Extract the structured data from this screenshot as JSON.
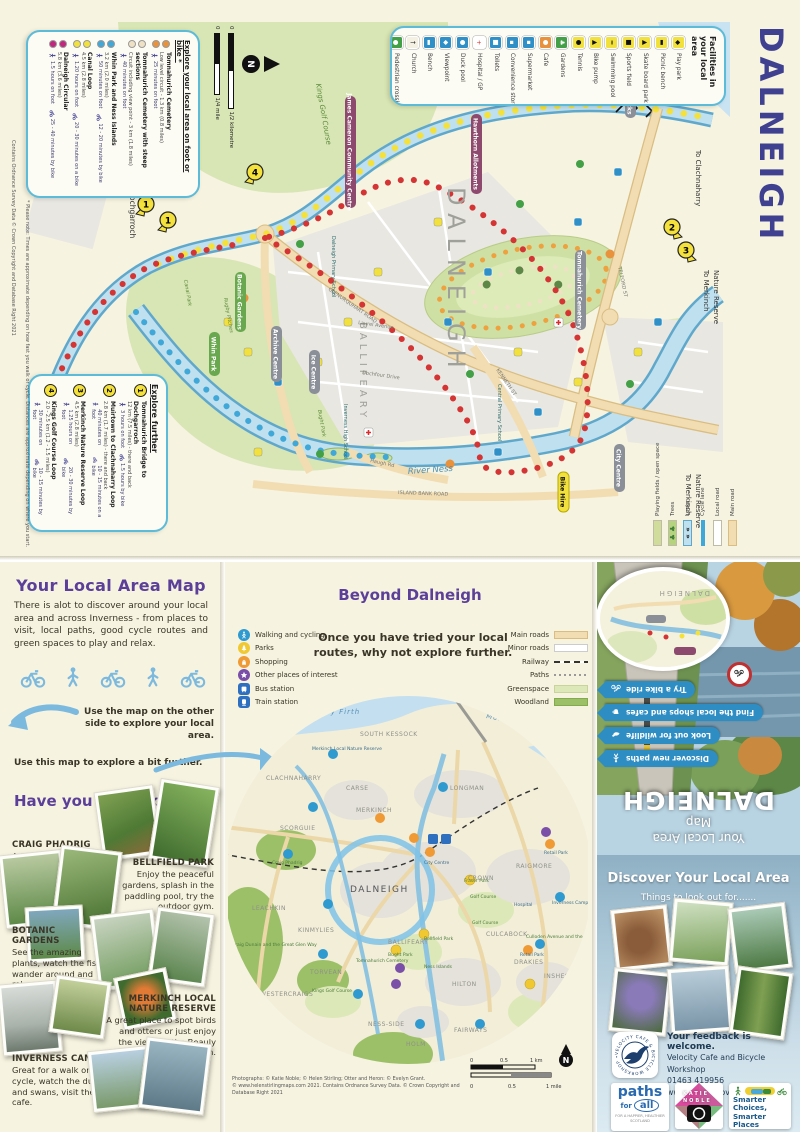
{
  "colors": {
    "accent_purple": "#5b3f99",
    "navy": "#3f4190",
    "light_blue": "#7cb9de",
    "ribbon_blue": "#2e8dc3"
  },
  "top_map": {
    "title": "DALNEIGH",
    "compass": "N",
    "scale": {
      "zero1": "0",
      "km": "1/2 kilometre",
      "zero2": "0",
      "mile": "1/4 mile"
    },
    "note": "* Please note: Times are approximate depending on how fast you walk or cycle. Distances are approximate depending on where you start.",
    "copyright": "Contains Ordnance Survey Data © Crown Copyright and Database Right 2021",
    "explore_local": {
      "title": "Explore your local area on foot or bike *",
      "routes": [
        {
          "name": "Tomnahurich Cemetery",
          "detail": "Low level circuit - 1.3 km (0.8 miles)",
          "foot": "25 minutes on foot",
          "bike": "",
          "color": "#e8923d"
        },
        {
          "name": "Tomnahurich Cemetery with steep sections",
          "detail": "Circuit including view point - 3 km (1.8 miles)",
          "foot": "40 minutes on foot",
          "bike": "",
          "color": "#efe2c4"
        },
        {
          "name": "Whin Park and Ness Islands",
          "detail": "3.2 km (2.0 miles)",
          "foot": "50 minutes on foot",
          "bike": "12 - 20 minutes by bike",
          "color": "#41a8d8"
        },
        {
          "name": "Canal Loop",
          "detail": "4.5 km (2.8 miles)",
          "foot": "1.20 hours on foot",
          "bike": "20 - 30 minutes on a bike",
          "color": "#f2e13c"
        },
        {
          "name": "Dalneigh Circular",
          "detail": "5.8 km (3.6 miles)",
          "foot": "1.5 hours on foot",
          "bike": "25 - 40 minutes by bike",
          "color": "#c2267d"
        }
      ]
    },
    "facilities": {
      "title": "Facilities in your local area",
      "items": [
        {
          "label": "Pedestrian crossing",
          "color": "#43a047",
          "g": "●",
          "gc": "#ffffff"
        },
        {
          "label": "Church",
          "color": "#f4f1e2",
          "g": "†",
          "gc": "#111111"
        },
        {
          "label": "Bench",
          "color": "#2f8fc7",
          "g": "▬",
          "gc": "#ffffff"
        },
        {
          "label": "Viewpoint",
          "color": "#2f8fc7",
          "g": "◆",
          "gc": "#ffffff"
        },
        {
          "label": "Duck pool",
          "color": "#2f8fc7",
          "g": "●",
          "gc": "#ffffff"
        },
        {
          "label": "Hospital / GP",
          "color": "#ffffff",
          "g": "+",
          "gc": "#d92c2c"
        },
        {
          "label": "Toilets",
          "color": "#2f8fc7",
          "g": "■",
          "gc": "#ffffff"
        },
        {
          "label": "Convenience store",
          "color": "#2f8fc7",
          "g": "▪",
          "gc": "#ffffff"
        },
        {
          "label": "Supermarket",
          "color": "#2f8fc7",
          "g": "▪",
          "gc": "#ffffff"
        },
        {
          "label": "Cafe",
          "color": "#e8923d",
          "g": "●",
          "gc": "#ffffff"
        },
        {
          "label": "Gardens",
          "color": "#43a047",
          "g": "♣",
          "gc": "#ffffff"
        },
        {
          "label": "Tennis",
          "color": "#f2e13c",
          "g": "●",
          "gc": "#111111"
        },
        {
          "label": "Bike pump",
          "color": "#f2e13c",
          "g": "▲",
          "gc": "#111111"
        },
        {
          "label": "Swimming pool",
          "color": "#f2e13c",
          "g": "≈",
          "gc": "#111111"
        },
        {
          "label": "Sports field",
          "color": "#f2e13c",
          "g": "■",
          "gc": "#111111"
        },
        {
          "label": "Skate board park",
          "color": "#f2e13c",
          "g": "▲",
          "gc": "#111111"
        },
        {
          "label": "Picnic bench",
          "color": "#f2e13c",
          "g": "▬",
          "gc": "#111111"
        },
        {
          "label": "Play park",
          "color": "#f2e13c",
          "g": "◆",
          "gc": "#111111"
        }
      ]
    },
    "explore_further": {
      "title": "Explore further",
      "routes": [
        {
          "num": "1",
          "name": "Tomnahurich Bridge to Dochgarroch",
          "detail": "12 km (7.5 miles) - there and back",
          "foot": "3 hours on foot",
          "bike": "1.5 hours by bike"
        },
        {
          "num": "2",
          "name": "Muirtown to Clachnaharry Loop",
          "detail": "2.8 km (1.7 miles) - there and back",
          "foot": "40 minutes on foot",
          "bike": "10 - 15 minutes on a bike"
        },
        {
          "num": "3",
          "name": "Merkinch Nature Reserve Loop",
          "detail": "4.5 km (2.8 miles)",
          "foot": "1.25 hours on foot",
          "bike": "20 - 30 minutes by bike"
        },
        {
          "num": "4",
          "name": "Kings Golf Course Loop",
          "detail": "2.0 - 2.5 km (1.2 - 1.5 miles)",
          "foot": "30 minutes on foot",
          "bike": "10 - 15 minutes by bike"
        }
      ]
    },
    "markers": [
      "1",
      "1",
      "2",
      "3",
      "4"
    ],
    "edge_labels": {
      "dochgarroch": "To Dochgarroch",
      "clachnaharry": "To Clachnaharry",
      "merkinch1": "To Merkinch",
      "merkinch2": "Nature Reserve"
    },
    "districts": {
      "dalneigh": "DALNEIGH",
      "ballifeary": "BALLIFEARY"
    },
    "water": {
      "river": "River Ness"
    },
    "roads": {
      "glenurquhart": "GLENURQUHART ROAD",
      "telford": "TELFORD ST",
      "kingbrude": "King Brude Road",
      "islandbank": "ISLAND BANK ROAD",
      "laurel": "Laurel Avenue",
      "dochfour": "Dochfour Drive",
      "kenneth": "KENNETH ST",
      "haugh": "Haugh Rd"
    },
    "green_labels": {
      "kings": "Kings Golf Course",
      "canalpark": "Canal Park",
      "rugby": "Rugby Pitches",
      "bught": "Bught Park"
    },
    "pills": {
      "whin": "Whin Park",
      "botanic": "Botanic Gardens",
      "archive": "Archive Centre",
      "ice": "Ice Centre",
      "muirtown": "Muirtown Locks",
      "city": "City Centre",
      "cemetery": "Tomnahurich Cemetery",
      "jamescameron": "James Cameron Community Centre",
      "hawthorn": "Hawthorn Allotments",
      "bikehire": "Bike Hire"
    },
    "schools": {
      "dalneigh_primary": "Dalneigh Primary School",
      "high": "Inverness High School",
      "central": "Central Primary School"
    },
    "mini_legend": [
      {
        "label": "Playing fields / open space",
        "kind": "fields"
      },
      {
        "label": "Trees",
        "kind": "trees"
      },
      {
        "label": "Locks",
        "kind": "locks"
      },
      {
        "label": "Cycle lane",
        "kind": "cycle"
      },
      {
        "label": "Local road",
        "kind": "local"
      },
      {
        "label": "Main road",
        "kind": "main"
      }
    ]
  },
  "left_panel": {
    "title": "Your Local Area Map",
    "intro": "There is alot to discover around your local area and across Inverness - from places to visit, local paths, good cycle routes and green spaces to play and relax.",
    "other_side": "Use the map on the other side to explore your local area.",
    "this_map": "Use this map  to explore a bit further.",
    "have_you": "Have you been to.......",
    "places": [
      {
        "name": "CRAIG PHADRIG",
        "desc": "A beautiful forest walk that takes you up the site of an historic hill fort."
      },
      {
        "name": "BELLFIELD PARK",
        "desc": "Enjoy the peaceful gardens, splash in the paddling pool, try the outdoor gym."
      },
      {
        "name": "BOTANIC GARDENS",
        "desc": "See the amazing plants, watch the fish, wander around and relax....inside or out."
      },
      {
        "name": "MERKINCH LOCAL NATURE RESERVE",
        "desc": "A great place to spot birds and otters or just enjoy the views of the Beauly Firth."
      },
      {
        "name": "INVERNESS CAMPUS",
        "desc": "Great for a walk or a cycle, watch the ducks and swans, visit the cafe."
      }
    ]
  },
  "beyond": {
    "title": "Beyond Dalneigh",
    "intro": "Once you have tried your local routes, why not explore further.",
    "legend_left": [
      {
        "label": "Walking and cycling",
        "color": "#2f9ad0",
        "icon": "#ic-walk",
        "shape": "ci"
      },
      {
        "label": "Parks",
        "color": "#f0c832",
        "icon": "#ic-tree",
        "shape": "ci"
      },
      {
        "label": "Shopping",
        "color": "#ef9a35",
        "icon": "#ic-bag",
        "shape": "ci"
      },
      {
        "label": "Other places of interest",
        "color": "#7a4fa8",
        "icon": "#ic-star",
        "shape": "ci"
      },
      {
        "label": "Bus station",
        "color": "#2f6fc0",
        "icon": "#ic-bus",
        "shape": "sq"
      },
      {
        "label": "Train station",
        "color": "#2f6fc0",
        "icon": "#ic-train",
        "shape": "sq"
      }
    ],
    "legend_right": [
      {
        "label": "Main roads",
        "kind": "main"
      },
      {
        "label": "Minor roads",
        "kind": "minor"
      },
      {
        "label": "Railway",
        "kind": "rail"
      },
      {
        "label": "Paths",
        "kind": "paths"
      },
      {
        "label": "Greenspace",
        "kind": "green"
      },
      {
        "label": "Woodland",
        "kind": "wood"
      }
    ],
    "water": {
      "beauly": "Beauly Firth",
      "moray": "Moray Firth"
    },
    "dalneigh": "DALNEIGH",
    "districts": [
      "SOUTH KESSOCK",
      "CLACHNAHARRY",
      "CARSE",
      "MERKINCH",
      "LONGMAN",
      "SCORGUIE",
      "LEACHKIN",
      "KINMYLIES",
      "CROWN",
      "RAIGMORE",
      "CULCABOCK",
      "DRAKIES",
      "INSHES",
      "HILTON",
      "BALLIFEARY",
      "TORVEAN",
      "WESTERCRAIGS",
      "NESS-SIDE",
      "HOLM",
      "FAIRWAYS"
    ],
    "places": [
      "Merkinch Local Nature Reserve",
      "Craig Phadrig",
      "Craig Dunain and the Great Glen Way",
      "Kings Golf Course",
      "Golf Course",
      "Golf Course",
      "Tomnahurich Cemetery",
      "Ness Islands",
      "Bught Park",
      "Bellfield Park",
      "Fraser Park",
      "City Centre",
      "Retail Park",
      "Retail Park",
      "Inverness Campus",
      "Hospital",
      "Culloden Avenue and the Gruffalo walk",
      "Darich Wood"
    ],
    "attribution1": "Photographs: © Katie Noble; © Helen Stirling; Otter and Heron: © Evelyn Grant.",
    "attribution2": "© www.helenstirlingmaps.com 2021. Contains Ordnance Survey Data. © Crown Copyright and Database Right 2021",
    "scalebar": {
      "k0": "0",
      "k05": "0.5",
      "k1": "1 km",
      "m0": "0",
      "m05": "0.5",
      "m1": "1 mile",
      "n": "N"
    }
  },
  "cover": {
    "kicker": "Your Local Area",
    "map_word": "Map",
    "title": "DALNEIGH",
    "inset_label": "DALNEIGH",
    "ribbons": [
      {
        "label": "Discover new paths",
        "icon": "#ic-walk"
      },
      {
        "label": "Look out for wildlife",
        "icon": "#ic-otter"
      },
      {
        "label": "Find the local shops and cafes",
        "icon": "#ic-cup"
      },
      {
        "label": "Try a bike ride",
        "icon": "#ic-bike"
      }
    ]
  },
  "discover": {
    "title": "Discover Your Local Area",
    "subtitle": "Things to look out for.......",
    "feedback_title": "Your feedback is welcome.",
    "feedback_org": "Velocity Cafe and Bicycle Workshop",
    "feedback_phone": "01463 419956",
    "feedback_web": "www.velocitylove.co.uk",
    "velocity_ring": "VELOCITY CAFE & BICYCLE WORKSHOP • ",
    "logos": {
      "paths1": "paths",
      "paths2": "for",
      "paths3": "all",
      "paths_tag": "FOR A HAPPIER, HEALTHIER SCOTLAND",
      "katie1": "KATIE",
      "katie2": "NOBLE",
      "smarter_title": "Smarter Choices, Smarter Places",
      "smarter_tag": "Supporting Sustainable Travel"
    }
  }
}
